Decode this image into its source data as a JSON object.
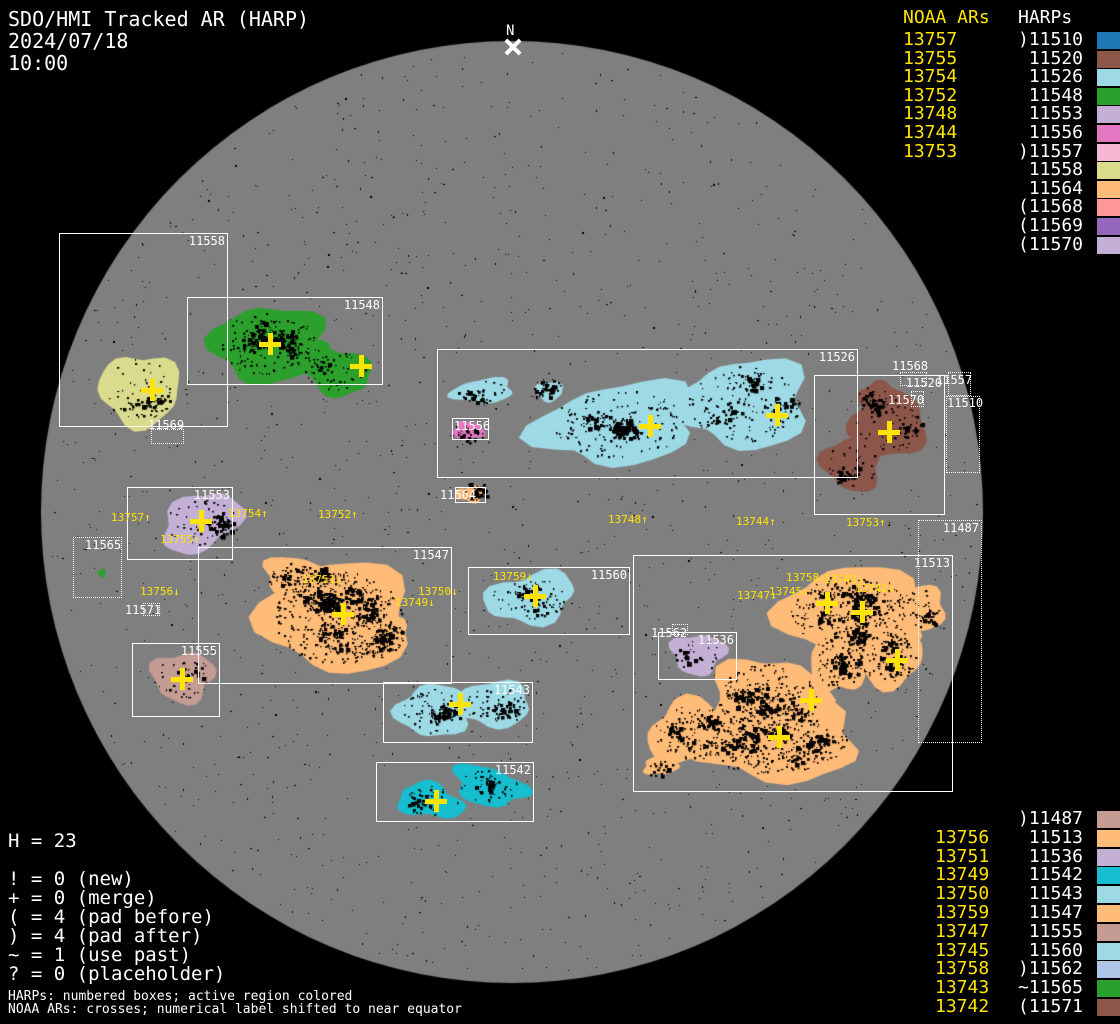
{
  "title": {
    "line1": "SDO/HMI Tracked AR (HARP)",
    "line2": "2024/07/18",
    "line3": "10:00"
  },
  "colors": {
    "background": "#000000",
    "disk": "#7f7f7f",
    "accent_yellow": "#ffe400",
    "label_white": "#ffffff"
  },
  "panels": {
    "top_right": {
      "noaa_header": "NOAA ARs",
      "harp_header": "HARPs",
      "rows": [
        {
          "noaa": "13757",
          "prefix": ")",
          "harp": "11510"
        },
        {
          "noaa": "13755",
          "prefix": "",
          "harp": "11520"
        },
        {
          "noaa": "13754",
          "prefix": "",
          "harp": "11526"
        },
        {
          "noaa": "13752",
          "prefix": "",
          "harp": "11548"
        },
        {
          "noaa": "13748",
          "prefix": "",
          "harp": "11553"
        },
        {
          "noaa": "13744",
          "prefix": "",
          "harp": "11556"
        },
        {
          "noaa": "13753",
          "prefix": ")",
          "harp": "11557"
        },
        {
          "noaa": "",
          "prefix": "",
          "harp": "11558"
        },
        {
          "noaa": "",
          "prefix": "",
          "harp": "11564"
        },
        {
          "noaa": "",
          "prefix": "(",
          "harp": "11568"
        },
        {
          "noaa": "",
          "prefix": "(",
          "harp": "11569"
        },
        {
          "noaa": "",
          "prefix": "(",
          "harp": "11570"
        }
      ]
    },
    "bottom_right": {
      "rows": [
        {
          "noaa": "",
          "prefix": ")",
          "harp": "11487"
        },
        {
          "noaa": "13756",
          "prefix": "",
          "harp": "11513"
        },
        {
          "noaa": "13751",
          "prefix": "",
          "harp": "11536"
        },
        {
          "noaa": "13749",
          "prefix": "",
          "harp": "11542"
        },
        {
          "noaa": "13750",
          "prefix": "",
          "harp": "11543"
        },
        {
          "noaa": "13759",
          "prefix": "",
          "harp": "11547"
        },
        {
          "noaa": "13747",
          "prefix": "",
          "harp": "11555"
        },
        {
          "noaa": "13745",
          "prefix": "",
          "harp": "11560"
        },
        {
          "noaa": "13758",
          "prefix": ")",
          "harp": "11562"
        },
        {
          "noaa": "13743",
          "prefix": "~",
          "harp": "11565"
        },
        {
          "noaa": "13742",
          "prefix": "(",
          "harp": "11571"
        }
      ]
    }
  },
  "legend": {
    "h_line": "H = 23",
    "items": [
      "! = 0 (new)",
      "+ = 0 (merge)",
      "( = 4 (pad before)",
      ") = 4 (pad after)",
      "~ = 1 (use past)",
      "? = 0 (placeholder)"
    ]
  },
  "footnotes": [
    "HARPs: numbered boxes; active region colored",
    "NOAA ARs: crosses; numerical label shifted to near equator"
  ],
  "chart_data": {
    "type": "scatter",
    "title": "SDO/HMI Tracked AR (HARP) solar disk map, 2024/07/18 10:00",
    "disk": {
      "cx": 512,
      "cy": 512,
      "r": 471
    },
    "north_marker": {
      "label": "N",
      "x": 513,
      "y": 47,
      "label_x": 506,
      "label_y": 24
    },
    "harp_colors": {
      "11487": "#c49c94",
      "11510": "#1f77b4",
      "11513": "#ffbb78",
      "11520": "#8c564b",
      "11526": "#9edae5",
      "11536": "#c5b0d5",
      "11542": "#17becf",
      "11543": "#9edae5",
      "11547": "#ffbb78",
      "11548": "#2ca02c",
      "11553": "#c5b0d5",
      "11555": "#c49c94",
      "11556": "#e377c2",
      "11557": "#f7b6d2",
      "11558": "#dbdb8d",
      "11560": "#9edae5",
      "11562": "#aec7e8",
      "11564": "#ffbb78",
      "11565": "#2ca02c",
      "11568": "#ff9896",
      "11569": "#9467bd",
      "11570": "#c5b0d5",
      "11571": "#8c564b"
    },
    "regions": [
      {
        "harp": "11558",
        "spots": 0.7,
        "lobes": [
          [
            140,
            390,
            40,
            36,
            0
          ]
        ]
      },
      {
        "harp": "11548",
        "spots": 1.1,
        "lobes": [
          [
            268,
            344,
            56,
            38,
            -5
          ],
          [
            336,
            371,
            36,
            23,
            15
          ],
          [
            303,
            352,
            26,
            16,
            0
          ]
        ]
      },
      {
        "harp": "11526",
        "spots": 1.0,
        "lobes": [
          [
            483,
            391,
            31,
            12,
            -5
          ],
          [
            617,
            424,
            80,
            40,
            -8
          ],
          [
            549,
            391,
            14,
            10,
            0
          ],
          [
            744,
            404,
            66,
            44,
            -4
          ]
        ]
      },
      {
        "harp": "11556",
        "spots": 0.4,
        "lobes": [
          [
            468,
            431,
            16,
            9,
            0
          ]
        ]
      },
      {
        "harp": "11564",
        "spots": 0.4,
        "lobes": [
          [
            470,
            494,
            14,
            8,
            0
          ]
        ]
      },
      {
        "harp": "11520",
        "spots": 0.9,
        "lobes": [
          [
            888,
            424,
            38,
            34,
            0
          ],
          [
            852,
            464,
            30,
            26,
            20
          ],
          [
            878,
            396,
            20,
            14,
            0
          ]
        ]
      },
      {
        "harp": "11553",
        "spots": 0.9,
        "lobes": [
          [
            201,
            522,
            42,
            27,
            -25
          ]
        ]
      },
      {
        "harp": "11565",
        "spots": 0,
        "lobes": [
          [
            102,
            573,
            4,
            4,
            0
          ]
        ]
      },
      {
        "harp": "11547",
        "spots": 1.8,
        "lobes": [
          [
            338,
            617,
            75,
            55,
            0
          ],
          [
            300,
            578,
            38,
            20,
            10
          ],
          [
            378,
            638,
            30,
            24,
            0
          ]
        ]
      },
      {
        "harp": "11560",
        "spots": 1.0,
        "lobes": [
          [
            531,
            598,
            45,
            25,
            -10
          ]
        ]
      },
      {
        "harp": "11543",
        "spots": 1.2,
        "lobes": [
          [
            433,
            711,
            36,
            26,
            0
          ],
          [
            493,
            704,
            38,
            23,
            0
          ]
        ]
      },
      {
        "harp": "11542",
        "spots": 0.9,
        "lobes": [
          [
            430,
            801,
            33,
            17,
            10
          ],
          [
            489,
            786,
            37,
            19,
            15
          ]
        ]
      },
      {
        "harp": "11555",
        "spots": 0.8,
        "lobes": [
          [
            183,
            677,
            31,
            25,
            0
          ]
        ]
      },
      {
        "harp": "11536",
        "spots": 0.8,
        "lobes": [
          [
            698,
            654,
            27,
            20,
            0
          ]
        ]
      },
      {
        "harp": "11513",
        "spots": 1.5,
        "lobes": [
          [
            853,
            613,
            72,
            46,
            0
          ],
          [
            919,
            608,
            27,
            22,
            0
          ],
          [
            888,
            658,
            34,
            29,
            0
          ],
          [
            838,
            660,
            28,
            34,
            0
          ],
          [
            768,
            700,
            58,
            42,
            0
          ],
          [
            776,
            741,
            84,
            40,
            0
          ],
          [
            693,
            733,
            45,
            32,
            0
          ],
          [
            660,
            766,
            17,
            9,
            0
          ]
        ]
      }
    ],
    "boxes": [
      {
        "harp": "11558",
        "style": "solid",
        "x": 59,
        "y": 233,
        "w": 169,
        "h": 194
      },
      {
        "harp": "11548",
        "style": "solid",
        "x": 187,
        "y": 297,
        "w": 196,
        "h": 88
      },
      {
        "harp": "11526",
        "style": "solid",
        "x": 437,
        "y": 349,
        "w": 421,
        "h": 129
      },
      {
        "harp": "11556",
        "style": "solid",
        "x": 452,
        "y": 418,
        "w": 37,
        "h": 22,
        "label_at": [
          454,
          420
        ]
      },
      {
        "harp": "11564",
        "style": "solid",
        "x": 455,
        "y": 487,
        "w": 31,
        "h": 16,
        "label_at": [
          440,
          489
        ]
      },
      {
        "harp": "11520",
        "style": "solid",
        "x": 814,
        "y": 375,
        "w": 131,
        "h": 140
      },
      {
        "harp": "11553",
        "style": "solid",
        "x": 127,
        "y": 487,
        "w": 106,
        "h": 73
      },
      {
        "harp": "11547",
        "style": "solid",
        "x": 198,
        "y": 547,
        "w": 254,
        "h": 137
      },
      {
        "harp": "11555",
        "style": "solid",
        "x": 132,
        "y": 643,
        "w": 88,
        "h": 74
      },
      {
        "harp": "11560",
        "style": "solid",
        "x": 468,
        "y": 567,
        "w": 162,
        "h": 68
      },
      {
        "harp": "11543",
        "style": "solid",
        "x": 383,
        "y": 682,
        "w": 150,
        "h": 61
      },
      {
        "harp": "11542",
        "style": "solid",
        "x": 376,
        "y": 762,
        "w": 158,
        "h": 60
      },
      {
        "harp": "11513",
        "style": "solid",
        "x": 633,
        "y": 555,
        "w": 320,
        "h": 237
      },
      {
        "harp": "11536",
        "style": "solid",
        "x": 658,
        "y": 632,
        "w": 79,
        "h": 48
      },
      {
        "harp": "11569",
        "style": "dotted",
        "x": 151,
        "y": 429,
        "w": 33,
        "h": 15,
        "label_at": [
          148,
          419
        ]
      },
      {
        "harp": "11565",
        "style": "dotted",
        "x": 73,
        "y": 537,
        "w": 49,
        "h": 61,
        "label_at": [
          85,
          539
        ]
      },
      {
        "harp": "11571",
        "style": "dotted",
        "x": 143,
        "y": 603,
        "w": 17,
        "h": 13,
        "label_at": [
          125,
          604
        ]
      },
      {
        "harp": "11568",
        "style": "dotted",
        "x": 900,
        "y": 372,
        "w": 27,
        "h": 14,
        "label_at": [
          892,
          360
        ]
      },
      {
        "harp": "11557",
        "style": "dotted",
        "x": 948,
        "y": 372,
        "w": 23,
        "h": 24,
        "label_at": [
          936,
          374
        ]
      },
      {
        "harp": "11570",
        "style": "dotted",
        "x": 911,
        "y": 391,
        "w": 13,
        "h": 16,
        "label_at": [
          888,
          394
        ]
      },
      {
        "harp": "11510",
        "style": "dotted",
        "x": 946,
        "y": 396,
        "w": 34,
        "h": 77,
        "label_at": [
          947,
          397
        ]
      },
      {
        "harp": "11487",
        "style": "dotted",
        "x": 918,
        "y": 520,
        "w": 64,
        "h": 223
      },
      {
        "harp": "11562",
        "style": "dotted",
        "x": 672,
        "y": 624,
        "w": 16,
        "h": 11,
        "label_at": [
          651,
          627
        ]
      }
    ],
    "crosses": [
      [
        152,
        390
      ],
      [
        270,
        344
      ],
      [
        361,
        366
      ],
      [
        650,
        426
      ],
      [
        777,
        415
      ],
      [
        889,
        432
      ],
      [
        201,
        521
      ],
      [
        343,
        614
      ],
      [
        535,
        596
      ],
      [
        460,
        704
      ],
      [
        436,
        801
      ],
      [
        182,
        679
      ],
      [
        827,
        603
      ],
      [
        862,
        612
      ],
      [
        897,
        660
      ],
      [
        811,
        700
      ],
      [
        779,
        737
      ]
    ],
    "noaa_labels": [
      {
        "text": "13757↑",
        "x": 111,
        "y": 512
      },
      {
        "text": "13755↑",
        "x": 160,
        "y": 534
      },
      {
        "text": "13754↑",
        "x": 228,
        "y": 508
      },
      {
        "text": "13752↑",
        "x": 318,
        "y": 509
      },
      {
        "text": "13748↑",
        "x": 608,
        "y": 514
      },
      {
        "text": "13744↑",
        "x": 736,
        "y": 516
      },
      {
        "text": "13753↑",
        "x": 846,
        "y": 517
      },
      {
        "text": "13756↓",
        "x": 140,
        "y": 586
      },
      {
        "text": "13751↓",
        "x": 302,
        "y": 574
      },
      {
        "text": "13750↓",
        "x": 418,
        "y": 586
      },
      {
        "text": "13749↓",
        "x": 395,
        "y": 597
      },
      {
        "text": "13759↓",
        "x": 493,
        "y": 571
      },
      {
        "text": "13747↓",
        "x": 737,
        "y": 590
      },
      {
        "text": "13745↓",
        "x": 769,
        "y": 586
      },
      {
        "text": "13758↓",
        "x": 786,
        "y": 572
      },
      {
        "text": "13743↓",
        "x": 824,
        "y": 574
      },
      {
        "text": "13742↓",
        "x": 855,
        "y": 583
      }
    ]
  }
}
